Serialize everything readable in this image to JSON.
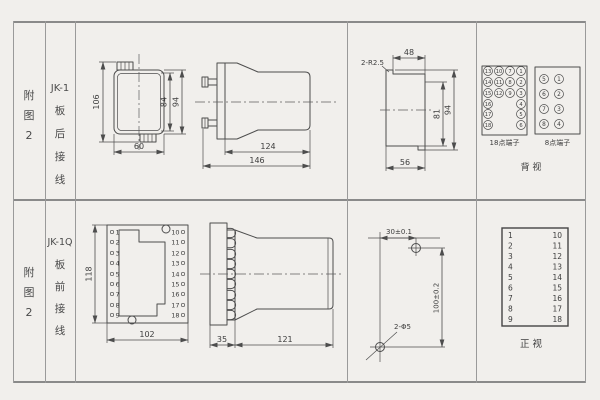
{
  "meta": {
    "bg": "#f1efec",
    "ink": "#4d4d4d",
    "grid": "#8a8a8a"
  },
  "rows": {
    "top": {
      "fig": [
        "附",
        "图",
        "2"
      ],
      "model": "JK-1",
      "wiring": [
        "板",
        "后",
        "接",
        "线"
      ],
      "front_view": {
        "dim_height": "106",
        "dim_inner": "84",
        "dim_outer": "94",
        "dim_width": "60"
      },
      "side_view": {
        "dim_body": "124",
        "dim_total": "146"
      },
      "cutout": {
        "radius_note": "2-R2.5",
        "dim_top": "48",
        "dim_inner": "81",
        "dim_outer": "94",
        "dim_bottom": "56"
      },
      "terminals": {
        "t18": {
          "label": "18点端子",
          "grid": [
            [
              "13",
              "10",
              "7",
              "1"
            ],
            [
              "14",
              "11",
              "8",
              "2"
            ],
            [
              "15",
              "12",
              "9",
              "3"
            ],
            [
              "16",
              "4"
            ],
            [
              "17",
              "5"
            ],
            [
              "18",
              "6"
            ]
          ]
        },
        "t8": {
          "label": "8点端子",
          "grid": [
            [
              "5",
              "1"
            ],
            [
              "6",
              "2"
            ],
            [
              "7",
              "3"
            ],
            [
              "8",
              "4"
            ]
          ]
        },
        "view": "背  视"
      }
    },
    "bottom": {
      "fig": [
        "附",
        "图",
        "2"
      ],
      "model": "JK-1Q",
      "wiring": [
        "板",
        "前",
        "接",
        "线"
      ],
      "board": {
        "left": [
          "1",
          "2",
          "3",
          "4",
          "5",
          "6",
          "7",
          "8",
          "9"
        ],
        "right": [
          "10",
          "11",
          "12",
          "13",
          "14",
          "15",
          "16",
          "17",
          "18"
        ],
        "dim_height": "118",
        "dim_width": "102"
      },
      "side_view": {
        "dim_board": "35",
        "dim_body": "121"
      },
      "drill": {
        "dim_x": "30±0.1",
        "dim_y": "100±0.2",
        "holes": "2-Φ5"
      },
      "table": {
        "left": [
          "1",
          "2",
          "3",
          "4",
          "5",
          "6",
          "7",
          "8",
          "9"
        ],
        "right": [
          "10",
          "11",
          "12",
          "13",
          "14",
          "15",
          "16",
          "17",
          "18"
        ],
        "view": "正  视"
      }
    }
  }
}
